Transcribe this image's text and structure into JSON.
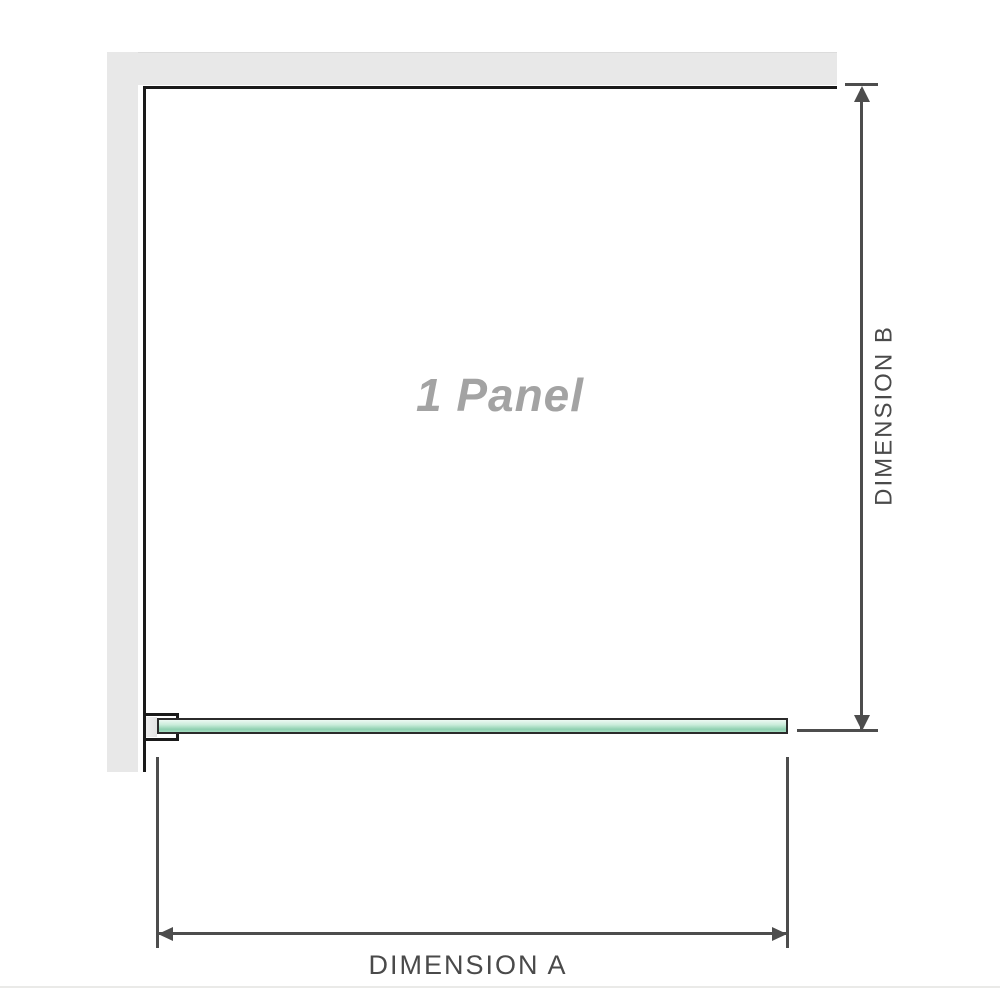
{
  "diagram": {
    "panel_label": "1 Panel",
    "dimension_a_label": "DIMENSION A",
    "dimension_b_label": "DIMENSION B",
    "icons": {
      "dim_b_arrow_top": "arrow-up-icon",
      "dim_b_arrow_bottom": "arrow-down-icon",
      "dim_a_arrow_left": "arrow-left-icon",
      "dim_a_arrow_right": "arrow-right-icon"
    },
    "colors": {
      "wall": "#e8e8e8",
      "wall_edge": "#dcdcdc",
      "panel_outline": "#1a1a1a",
      "dimension": "#4d4d4d",
      "label_text": "#4a4a4a",
      "panel_text": "#a3a3a3",
      "glass_light": "#eef9f3",
      "glass_mid": "#c9ecda",
      "glass_dark": "#8fd0b0",
      "glass_outline": "#2b2b2b",
      "clamp_fill": "#ffffff",
      "clamp_block": "#e3e3e3",
      "separator": "#eaeae8"
    }
  }
}
